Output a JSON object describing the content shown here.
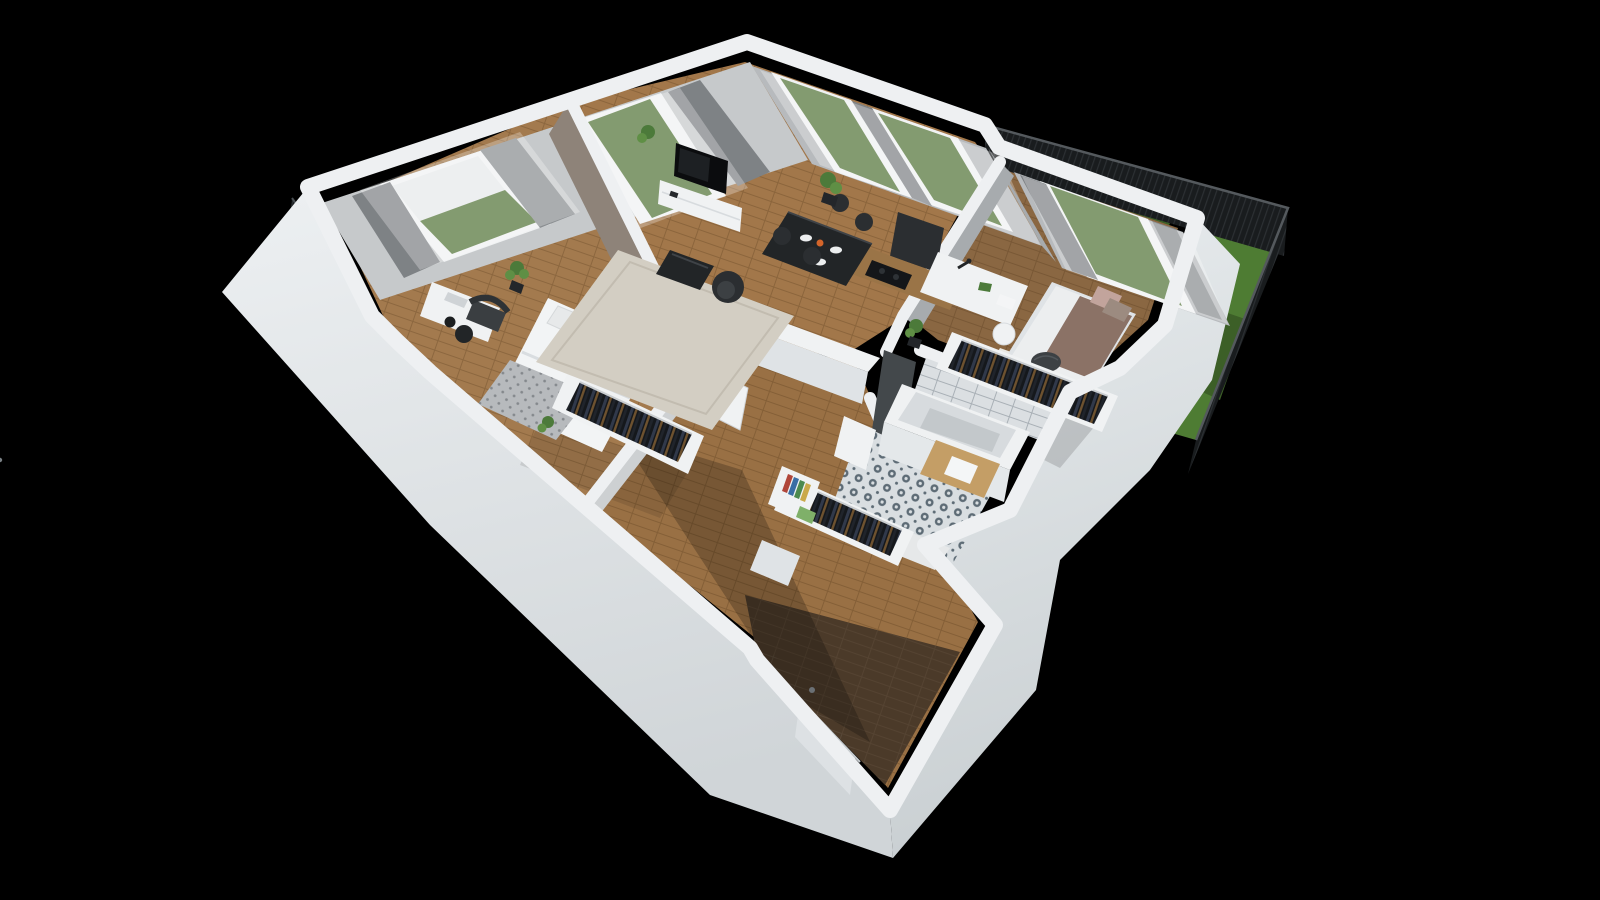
{
  "scene": {
    "kind": "3d-apartment-floorplan-render",
    "view": "isometric-cutaway-from-above",
    "background": "solid-black",
    "no_visible_text": true
  },
  "rooms": [
    {
      "name": "master-bedroom",
      "items": [
        "double-bed",
        "pillows",
        "patterned-throw",
        "open-wardrobe-with-clothes",
        "window-console-desk",
        "dark-armchair",
        "round-side-table",
        "potted-plants",
        "window-with-curtains"
      ]
    },
    {
      "name": "living-dining-room",
      "items": [
        "area-rug",
        "coffee-table",
        "swivel-armchair",
        "tv-sideboard",
        "tv",
        "dining-table",
        "dining-chairs-x4",
        "tableware",
        "tall-plant",
        "balcony-door",
        "two-windows-with-curtains"
      ]
    },
    {
      "name": "kitchen-nook",
      "items": [
        "wood-counter",
        "cooktop",
        "tall-dark-cabinet",
        "white-half-wall"
      ]
    },
    {
      "name": "bedroom-2",
      "items": [
        "white-desk",
        "desk-lamp",
        "toy-dinosaur",
        "white-chair",
        "single-bed",
        "rose-pillows",
        "dark-pouf",
        "open-wardrobe-with-clothes",
        "small-white-rug",
        "plant",
        "window-with-curtains"
      ]
    },
    {
      "name": "bathroom",
      "items": [
        "bathtub",
        "white-tile-wall",
        "charcoal-tile-wall",
        "patterned-floor-tiles",
        "wood-sink-deck",
        "white-basin",
        "door-ajar"
      ]
    },
    {
      "name": "hallway",
      "items": [
        "closet-with-clothes",
        "bookshelf-with-books",
        "shoe-cabinet",
        "interior-door-open"
      ]
    },
    {
      "name": "entrance-vestibule",
      "items": [
        "dark-wood-floor",
        "entrance-door-with-handle"
      ]
    },
    {
      "name": "exterior",
      "items": [
        "garden-terrace-lawn",
        "dark-mesh-fence",
        "left-side-balcony"
      ]
    }
  ],
  "colors": {
    "bg": "#000000",
    "wallTop": "#eef0f2",
    "faceNW": "#c6c9cb",
    "faceNE": "#b7babd",
    "faceNEd": "#a7abae",
    "grayface": "#cdd0d2",
    "taupe": "#8e8379",
    "charcoal": "#43484b",
    "woodLiving": "#a2774a",
    "woodMaster": "#a37a4e",
    "woodHall": "#99704494",
    "woodBed2": "#8a6742",
    "woodVestibule": "#4b3a29",
    "rug": "#d3cec3",
    "rugWhite": "#e9e7e2",
    "grass": "#4e7c33",
    "grassDark": "#3c5f27",
    "glassGreen": "#547539",
    "furnWhite": "#f0f2f3",
    "furnWhite2": "#dfe3e6",
    "furnBlack": "#222527",
    "furnDark": "#2b2e31",
    "chairGray": "#3a3e41",
    "duvet": "#f2f4f5",
    "pillow": "#e7e9ea",
    "blanket": "#b7babd",
    "sheer": "#ffffff",
    "curtain": "#7e8285",
    "curtain2": "#8a8e91",
    "tubRim": "#eff1f2",
    "tubInner": "#d7dbde",
    "tubFace": "#e4e8ea",
    "sinkWhite": "#f4f6f7",
    "deckWood": "#c49e66",
    "counterWood": "#9a7447",
    "pillowRose": "#c2a49c",
    "bedBrown": "#8b7266",
    "pouf": "#3d4144",
    "plant1": "#4c7a3a",
    "plant2": "#5f8f45",
    "pot": "#23262a",
    "closetBg": "#15181c",
    "clothesNavy": "#31394a",
    "clothesBrown": "#6e522f",
    "clothesDark": "#20242b",
    "fence": "#191c1e",
    "fenceLine": "#2c3033",
    "tileWall": "#dbdfe2",
    "bathFloor": "#d9dee1",
    "bathMotif": "#5d6b75",
    "frameLine": "#d0d4d7"
  }
}
